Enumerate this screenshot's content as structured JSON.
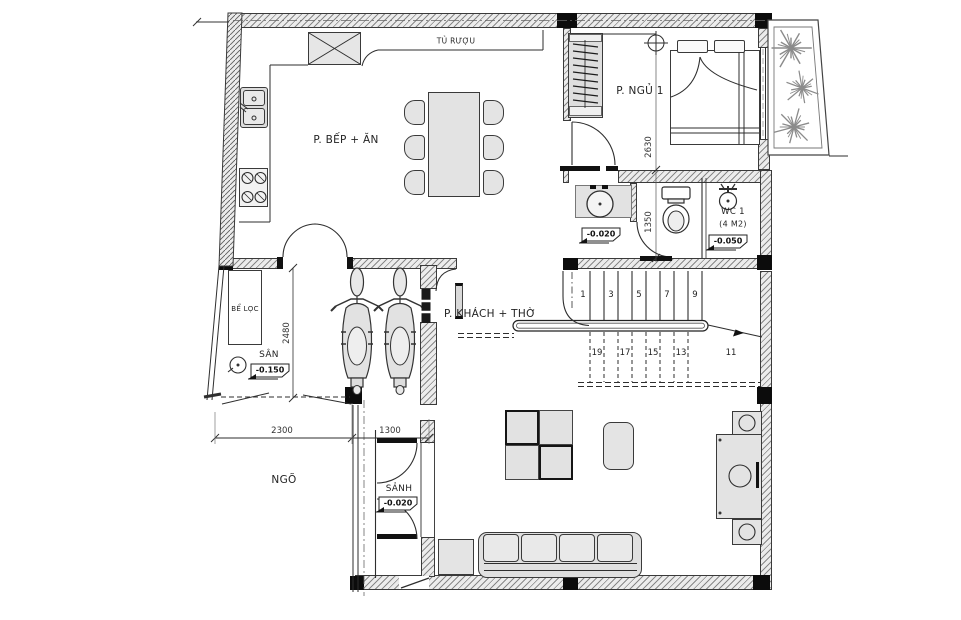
{
  "plan": {
    "rooms": {
      "kitchen": "P. BẾP + ĂN",
      "bedroom": "P. NGỦ 1",
      "living": "P. KHÁCH + THỜ",
      "wc": "WC 1",
      "wc_area": "(4 M2)",
      "hall": "SẢNH",
      "yard": "SÂN",
      "alley": "NGÕ",
      "filter_tank": "BỂ LỌC",
      "wine_cabinet": "TỦ RƯỢU"
    },
    "levels": {
      "wc_lobby": "-0.020",
      "wc1": "-0.050",
      "yard": "-0.150",
      "hall": "-0.020"
    },
    "dimensions": {
      "bedroom_depth": "2630",
      "wc_depth": "1350",
      "yard_depth": "2480",
      "alley_width": "2300",
      "hall_width": "1300"
    },
    "stairs": {
      "upper": [
        "1",
        "3",
        "5",
        "7",
        "9"
      ],
      "lower": [
        "19",
        "17",
        "15",
        "13",
        "11"
      ]
    },
    "colors": {
      "line": "#2e2e2e",
      "wall_fill": "#ececec",
      "furniture_fill": "#e4e4e4",
      "column": "#0c0c0c",
      "plant": "#8b8b8b"
    }
  }
}
